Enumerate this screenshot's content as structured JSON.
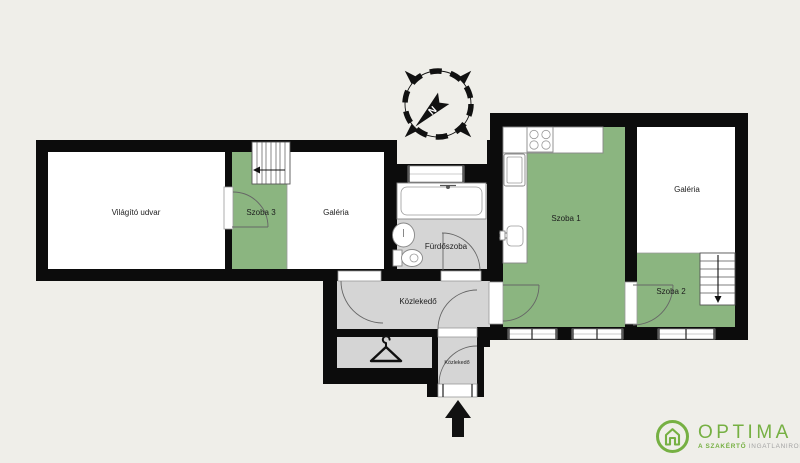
{
  "title": "Apartment floor plan",
  "colors": {
    "background": "#efeee9",
    "wall": "#0c0c0c",
    "room_green": "#8bb580",
    "floor_gray": "#d5d5d5",
    "room_white": "#ffffff",
    "logo_green": "#76b043",
    "logo_gray": "#a3a3a3"
  },
  "rooms": {
    "vilagito_udvar": {
      "label": "Világító udvar"
    },
    "szoba3": {
      "label": "Szoba 3"
    },
    "galeria_left": {
      "label": "Galéria"
    },
    "furdoszoba": {
      "label": "Fürdőszoba"
    },
    "kozlekedo": {
      "label": "Közlekedő"
    },
    "kozlekedo_small": {
      "label": "Közlekedő"
    },
    "szoba1": {
      "label": "Szoba 1"
    },
    "galeria_right": {
      "label": "Galéria"
    },
    "szoba2": {
      "label": "Szoba 2"
    }
  },
  "compass": {
    "north_label": "N"
  },
  "logo": {
    "brand": "OPTIMA",
    "tagline_accent": "A SZAKÉRTŐ",
    "tagline_rest": "INGATLANIRODA"
  }
}
